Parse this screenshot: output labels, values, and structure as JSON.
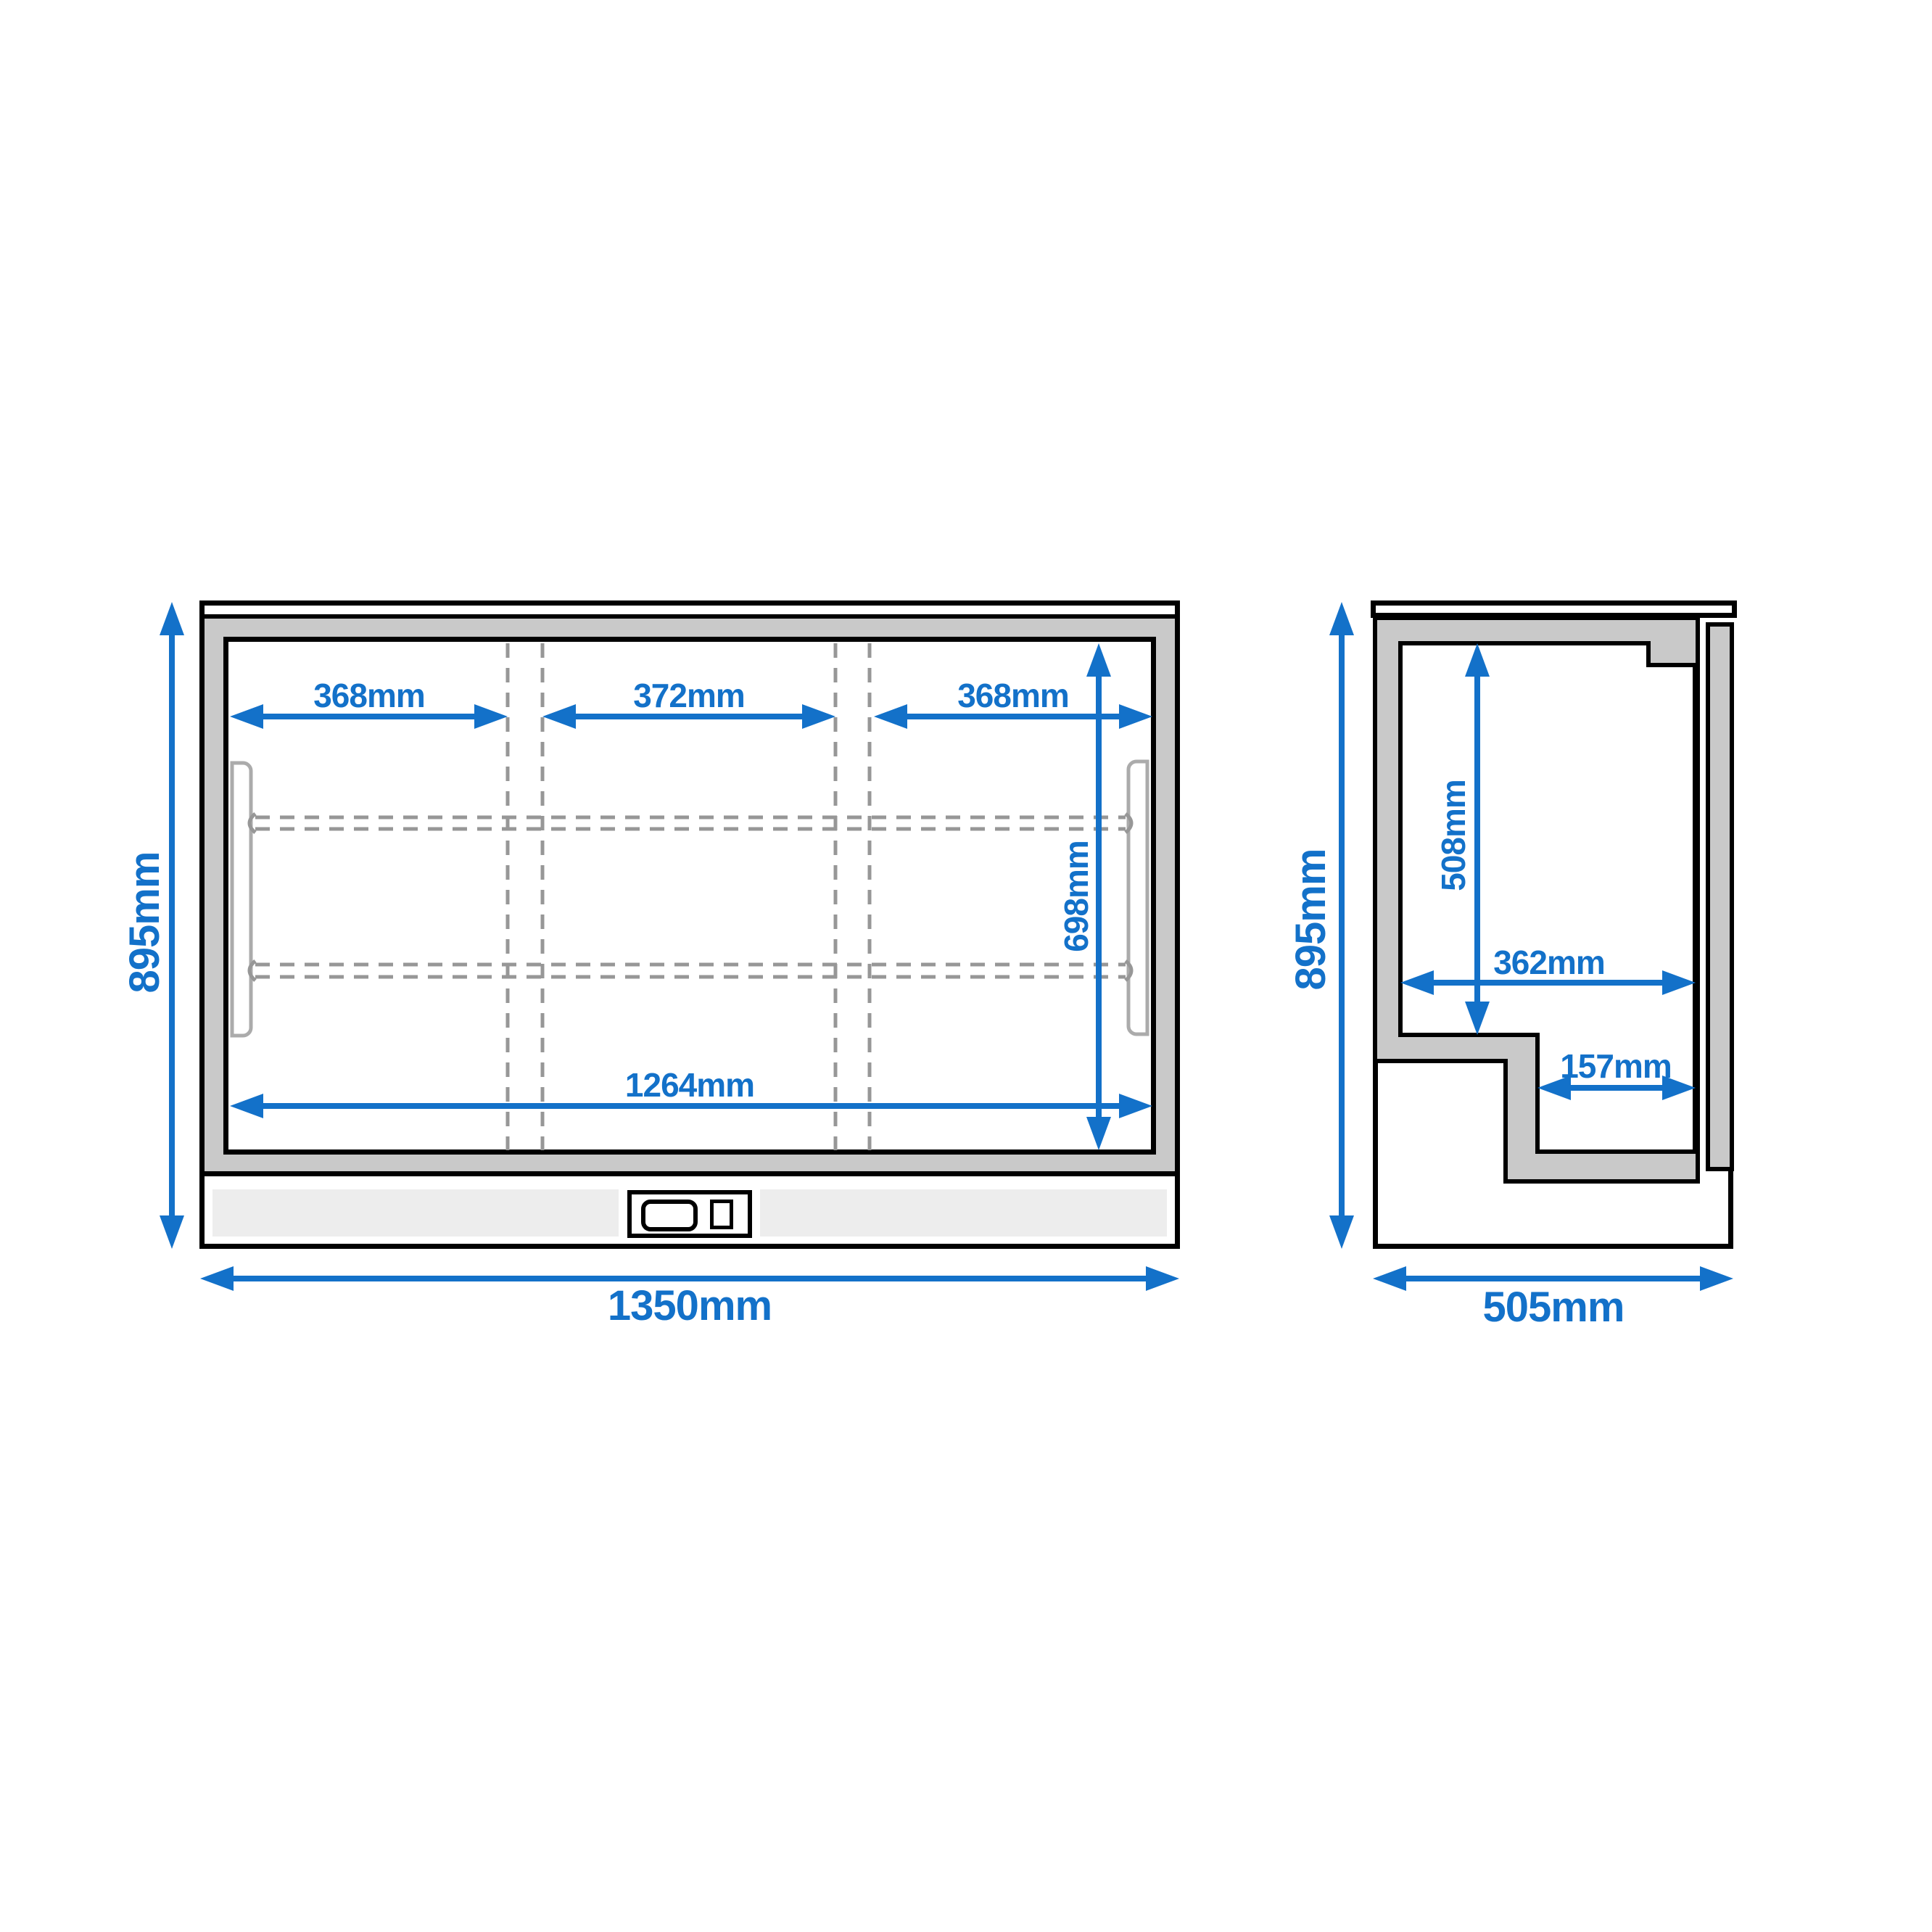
{
  "title": "Back bar cooler dimension drawing",
  "colors": {
    "accent": "#1371c9",
    "outline": "#000000",
    "insulation_fill": "#c9c9c9",
    "plinth_fill": "#ededed",
    "hidden_line": "#979797",
    "gasket": "#ababab",
    "background": "#ffffff"
  },
  "front_view": {
    "dims": {
      "overall_height": "895mm",
      "overall_width": "1350mm",
      "section_left": "368mm",
      "section_middle": "372mm",
      "section_right": "368mm",
      "interior_height": "698mm",
      "interior_width": "1264mm"
    }
  },
  "side_view": {
    "dims": {
      "overall_height": "895mm",
      "overall_depth": "505mm",
      "interior_height": "508mm",
      "interior_depth": "362mm",
      "lower_step_depth": "157mm"
    }
  }
}
